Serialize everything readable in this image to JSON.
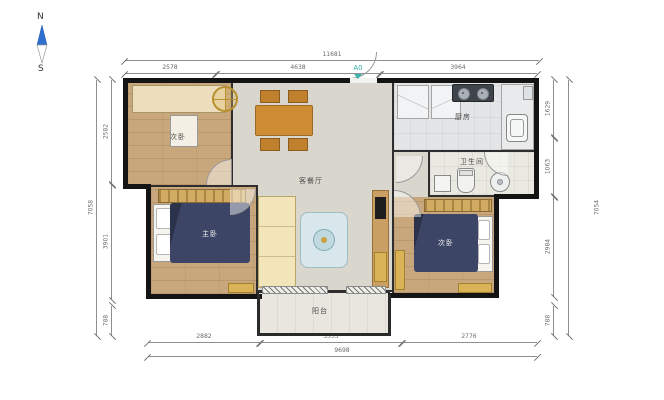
{
  "compass": {
    "north": "N",
    "south": "S"
  },
  "entry_marker": {
    "label": "A0",
    "color": "#35b3ae"
  },
  "rooms": {
    "study": {
      "label": "次卧"
    },
    "living_dining": {
      "label": "客餐厅"
    },
    "kitchen": {
      "label": "厨房"
    },
    "bathroom": {
      "label": "卫生间"
    },
    "master_bedroom": {
      "label": "主卧"
    },
    "second_bedroom": {
      "label": "次卧"
    },
    "balcony": {
      "label": "阳台"
    }
  },
  "dimensions": {
    "top": {
      "total": "11681",
      "segments": [
        "2578",
        "4638",
        "3964"
      ]
    },
    "bottom": {
      "total": "9698",
      "segments": [
        "2882",
        "3553",
        "2776"
      ]
    },
    "left": {
      "total": "7058",
      "segments": [
        "2582",
        "3901",
        "788"
      ]
    },
    "right": {
      "total": "7054",
      "segments": [
        "1629",
        "1063",
        "2984",
        "788"
      ]
    }
  },
  "colors": {
    "wall": "#141414",
    "wood_floor": "#c9a77c",
    "living_floor": "#d9d6cd",
    "bed": "#3d4566",
    "sofa": "#f1e5b9",
    "accent_gold": "#d9b356",
    "entry_accent": "#35b3ae",
    "compass_north": "#2e6fd0"
  }
}
